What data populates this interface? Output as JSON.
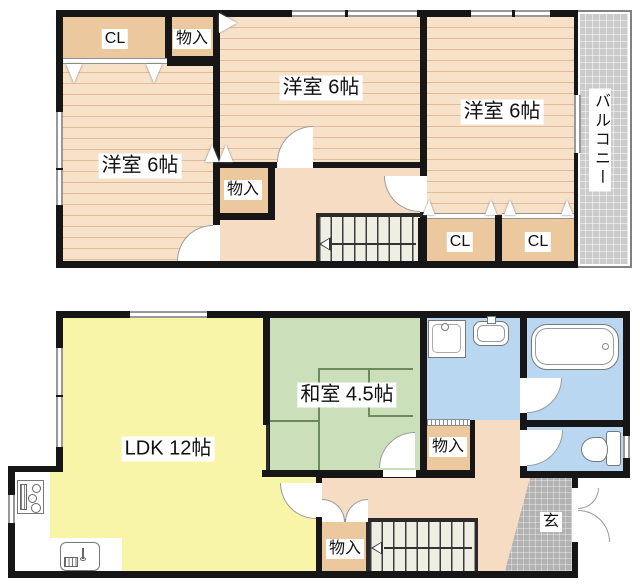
{
  "upper": {
    "closet_top_left": "CL",
    "storage_top": "物入",
    "room_left": "洋室 6帖",
    "room_center": "洋室 6帖",
    "room_right": "洋室 6帖",
    "storage_hall": "物入",
    "closet_right_left": "CL",
    "closet_right_right": "CL",
    "balcony": "バルコニー"
  },
  "lower": {
    "ldk": "LDK 12帖",
    "japanese_room": "和室 4.5帖",
    "storage_washroom": "物入",
    "storage_hall": "物入",
    "entrance": "玄"
  },
  "colors": {
    "wall": "#161616",
    "flooring": "#f8e1c9",
    "flooring_stripe": "#e2bb9b",
    "closet_orange": "#ebc89d",
    "hallway": "#f6dcc2",
    "ldk_yellow": "#f8f5a9",
    "tatami_green": "#cbe0ba",
    "water_blue": "#b9d7f1",
    "genkan_gray": "#b2b2b2",
    "balcony_gray": "#cbcbcb",
    "stairs_cream": "#efeee3"
  }
}
